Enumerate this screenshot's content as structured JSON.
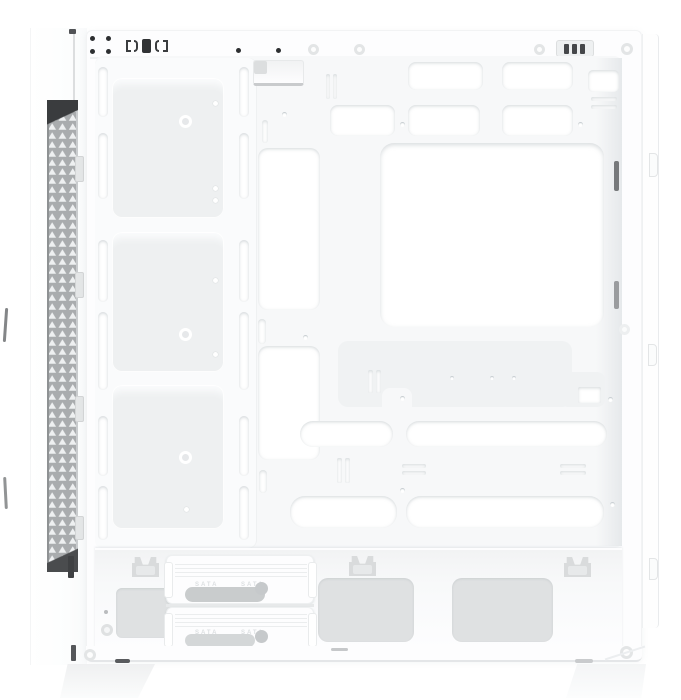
{
  "meta": {
    "type": "product-photo",
    "subject": "White mid-tower PC case, side view with side panel removed showing front fan bracket, motherboard tray cutouts, PSU shroud and drive trays",
    "canvas": {
      "width": 681,
      "height": 700
    }
  },
  "labels": {
    "sata": "SATA"
  },
  "colors": {
    "background": "#ffffff",
    "chassis": "#fdfdfe",
    "tray": "#f7f8f9",
    "recess": "#f0f2f3",
    "fan_plate": "#eef0f1",
    "vent": "#dfe1e2",
    "opening": "#c9cccd",
    "mesh": "#a9acae",
    "mesh_light": "#eef0f1",
    "dark": "#3b3d3f",
    "edge": "#e7e9eb"
  }
}
